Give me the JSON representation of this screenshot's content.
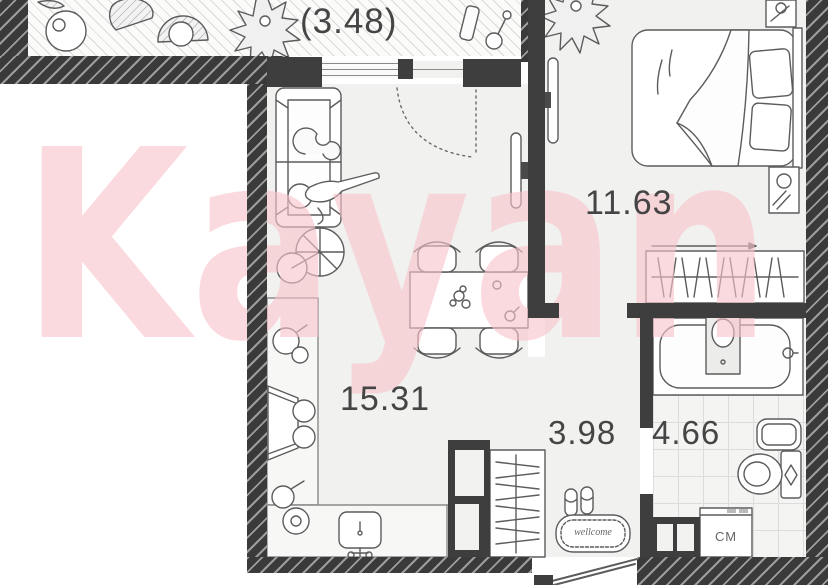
{
  "document": {
    "kind": "apartment-floor-plan"
  },
  "watermark": {
    "text": "Kayan",
    "color": "#f8c4cb"
  },
  "rooms": {
    "balcony": {
      "area_label": "(3.48)"
    },
    "bedroom": {
      "area_label": "11.63"
    },
    "living_kitchen": {
      "area_label": "15.31"
    },
    "hallway": {
      "area_label": "3.98"
    },
    "bathroom": {
      "area_label": "4.66"
    }
  },
  "annotations": {
    "door_mat": "wellcome",
    "washing_machine": "СМ"
  },
  "palette": {
    "wall_dark": "#3d3d3d",
    "floor": "#f1f1f0",
    "furniture_line": "#5c5c5c",
    "watermark_pink": "#f8c4cb",
    "tile_line": "#dcdcdc"
  }
}
